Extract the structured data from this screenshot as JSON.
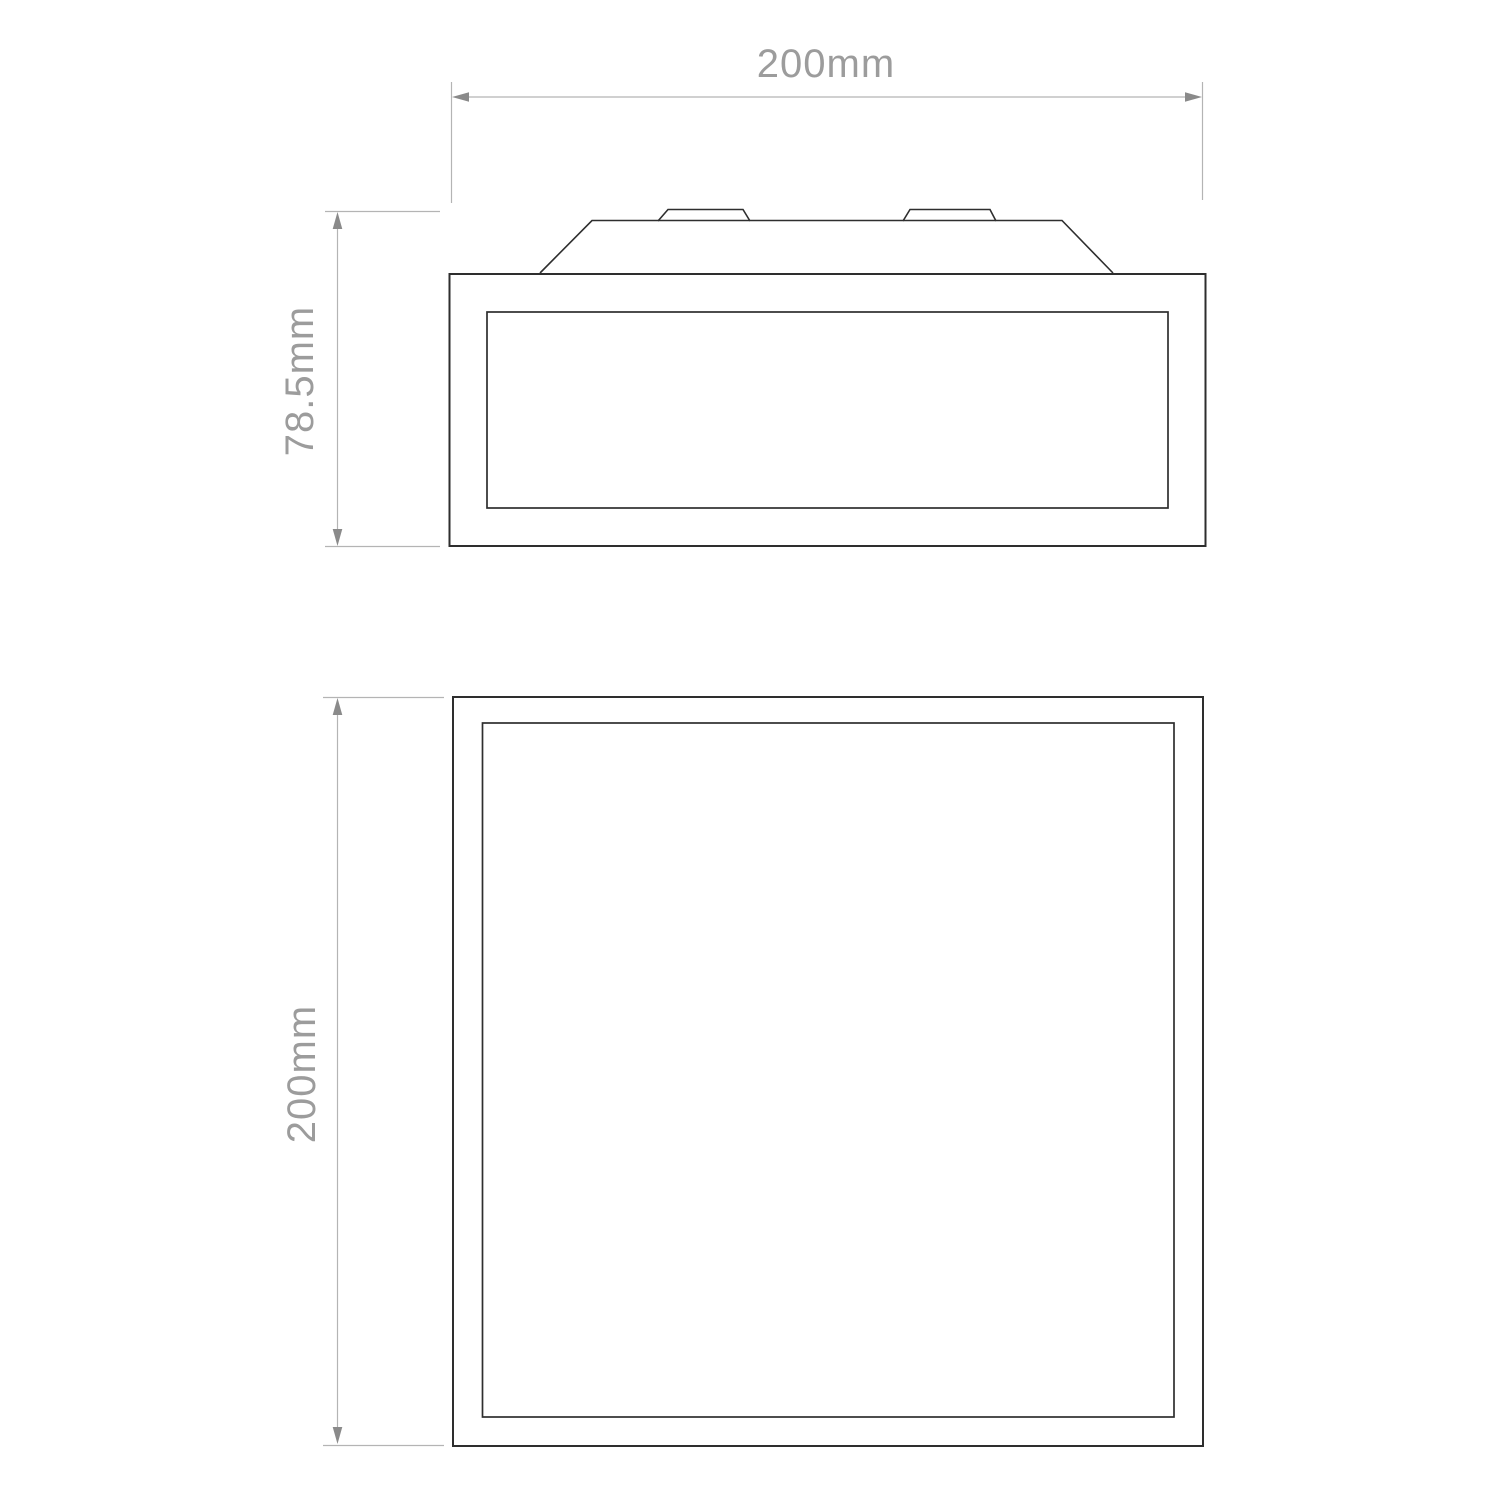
{
  "diagram": {
    "dimensions": {
      "width_label": "200mm",
      "depth_label": "78.5mm",
      "height_label": "200mm"
    },
    "colors": {
      "outline": "#2e2e2e",
      "dim_line": "#b4b4b4",
      "arrow": "#8a8a8a",
      "text": "#9c9c9c",
      "background": "#ffffff"
    }
  }
}
